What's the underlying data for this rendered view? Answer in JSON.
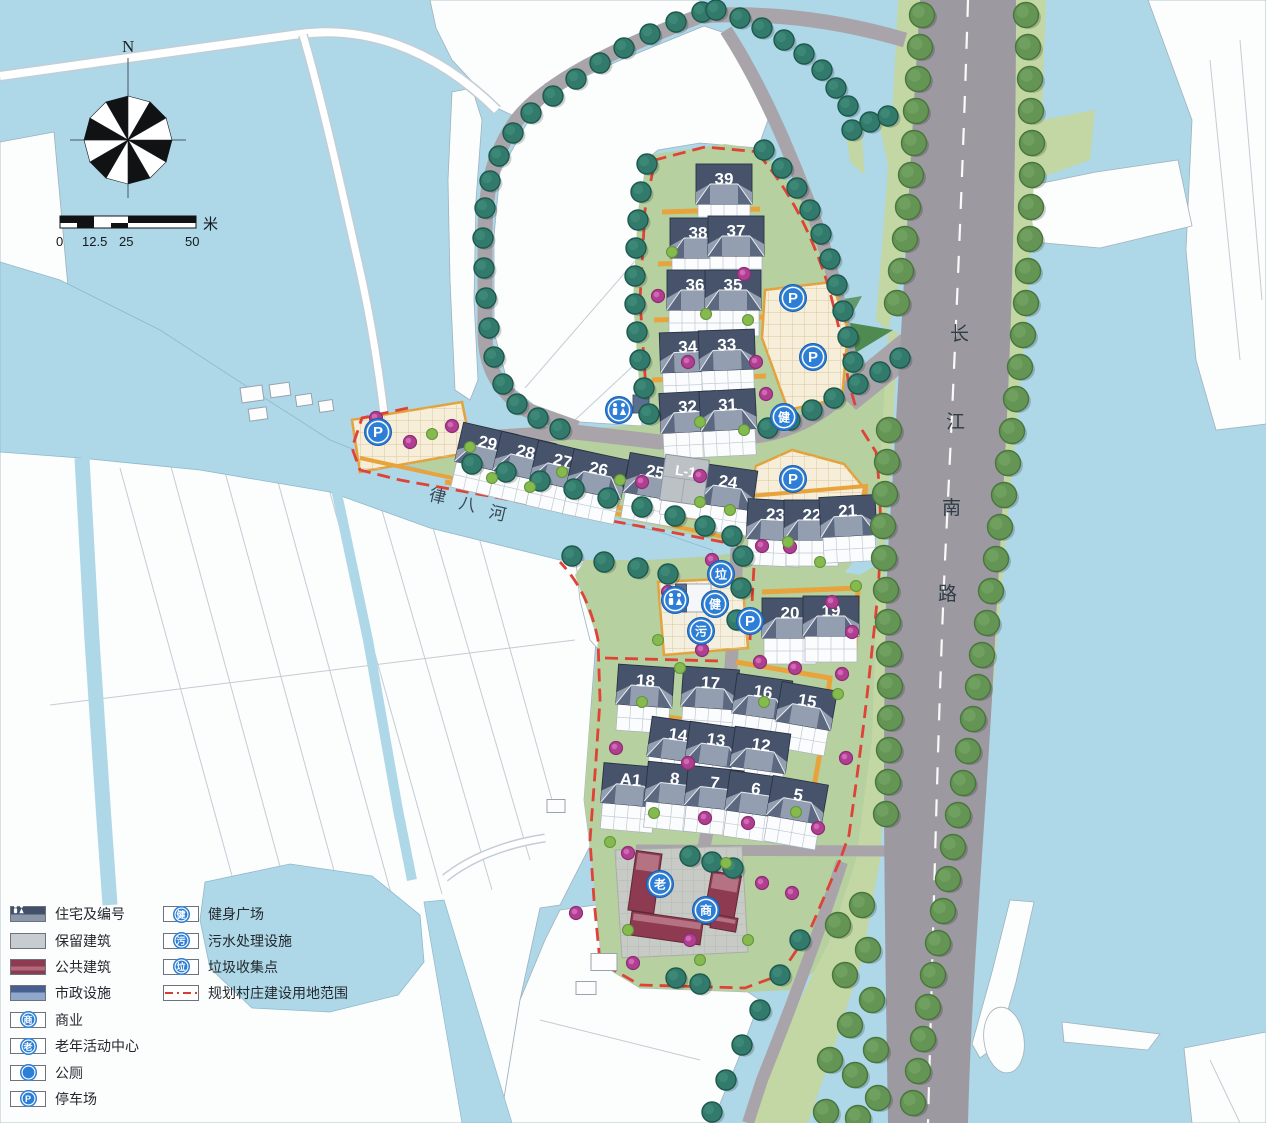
{
  "compass": {
    "north": "N"
  },
  "scale_bar": {
    "ticks": [
      "0",
      "12.5",
      "25",
      "50"
    ],
    "unit": "米"
  },
  "labels": {
    "river": [
      "律",
      "八",
      "河"
    ],
    "road": [
      "长",
      "江",
      "南",
      "路"
    ]
  },
  "legend": {
    "left": [
      {
        "label": "住宅及编号",
        "type": "swatch-residence"
      },
      {
        "label": "保留建筑",
        "type": "swatch-retained"
      },
      {
        "label": "公共建筑",
        "type": "swatch-public"
      },
      {
        "label": "市政设施",
        "type": "swatch-municipal"
      },
      {
        "label": "商业",
        "type": "icon",
        "glyph": "商"
      },
      {
        "label": "老年活动中心",
        "type": "icon",
        "glyph": "老"
      },
      {
        "label": "公厕",
        "type": "icon",
        "glyph": "WC"
      },
      {
        "label": "停车场",
        "type": "icon",
        "glyph": "P"
      }
    ],
    "right": [
      {
        "label": "健身广场",
        "type": "icon",
        "glyph": "健"
      },
      {
        "label": "污水处理设施",
        "type": "icon",
        "glyph": "污"
      },
      {
        "label": "垃圾收集点",
        "type": "icon",
        "glyph": "垃"
      },
      {
        "label": "规划村庄建设用地范围",
        "type": "boundary-line"
      }
    ]
  },
  "map": {
    "residential": [
      [
        "39",
        724,
        186,
        0
      ],
      [
        "38",
        698,
        240,
        0
      ],
      [
        "37",
        736,
        238,
        0
      ],
      [
        "36",
        695,
        292,
        0
      ],
      [
        "35",
        733,
        292,
        0
      ],
      [
        "34",
        688,
        354,
        -2
      ],
      [
        "33",
        727,
        352,
        -2
      ],
      [
        "32",
        688,
        414,
        -3
      ],
      [
        "31",
        728,
        412,
        -3
      ],
      [
        "29",
        486,
        450,
        13
      ],
      [
        "28",
        524,
        459,
        13
      ],
      [
        "27",
        561,
        468,
        13
      ],
      [
        "26",
        597,
        476,
        12
      ],
      [
        "25",
        654,
        479,
        10
      ],
      [
        "24",
        727,
        489,
        8
      ],
      [
        "23",
        775,
        522,
        3
      ],
      [
        "22",
        812,
        522,
        0
      ],
      [
        "21",
        848,
        518,
        -3
      ],
      [
        "20",
        790,
        620,
        0
      ],
      [
        "19",
        831,
        618,
        0
      ],
      [
        "18",
        645,
        688,
        4
      ],
      [
        "17",
        710,
        690,
        4
      ],
      [
        "16",
        762,
        699,
        8
      ],
      [
        "15",
        806,
        708,
        10
      ],
      [
        "14",
        677,
        742,
        8
      ],
      [
        "13",
        715,
        747,
        8
      ],
      [
        "12",
        760,
        752,
        8
      ],
      [
        "A1",
        630,
        787,
        5
      ],
      [
        "8",
        674,
        786,
        6
      ],
      [
        "7",
        714,
        790,
        6
      ],
      [
        "6",
        755,
        796,
        8
      ],
      [
        "5",
        797,
        802,
        10
      ]
    ],
    "retained": [
      [
        "L-1",
        684,
        483,
        8
      ]
    ],
    "public": [
      [
        645,
        882,
        26,
        60,
        8
      ],
      [
        666,
        928,
        72,
        24,
        8
      ],
      [
        722,
        900,
        30,
        54,
        10
      ],
      [
        724,
        923,
        26,
        14,
        10
      ]
    ],
    "municipal": [
      [
        641,
        404,
        16,
        18,
        0,
        "blue"
      ],
      [
        694,
        598,
        34,
        28,
        0,
        "white"
      ],
      [
        681,
        598,
        11,
        28,
        0,
        "blue"
      ]
    ],
    "existing": [
      [
        252,
        394,
        22,
        15,
        -8
      ],
      [
        280,
        390,
        20,
        13,
        -8
      ],
      [
        258,
        414,
        18,
        12,
        -8
      ],
      [
        304,
        400,
        16,
        11,
        -8
      ],
      [
        326,
        406,
        14,
        11,
        -8
      ],
      [
        556,
        806,
        18,
        13,
        0
      ],
      [
        604,
        962,
        26,
        17,
        0
      ],
      [
        586,
        988,
        20,
        13,
        0
      ]
    ],
    "trees_teal": [
      [
        702,
        12
      ],
      [
        676,
        22
      ],
      [
        650,
        34
      ],
      [
        624,
        48
      ],
      [
        600,
        63
      ],
      [
        576,
        79
      ],
      [
        553,
        96
      ],
      [
        531,
        113
      ],
      [
        513,
        133
      ],
      [
        499,
        156
      ],
      [
        490,
        181
      ],
      [
        485,
        208
      ],
      [
        483,
        238
      ],
      [
        484,
        268
      ],
      [
        486,
        298
      ],
      [
        489,
        328
      ],
      [
        494,
        357
      ],
      [
        503,
        384
      ],
      [
        517,
        404
      ],
      [
        538,
        418
      ],
      [
        560,
        429
      ],
      [
        647,
        164
      ],
      [
        641,
        192
      ],
      [
        638,
        220
      ],
      [
        636,
        248
      ],
      [
        635,
        276
      ],
      [
        635,
        304
      ],
      [
        637,
        332
      ],
      [
        640,
        360
      ],
      [
        644,
        388
      ],
      [
        649,
        414
      ],
      [
        764,
        150
      ],
      [
        782,
        168
      ],
      [
        797,
        188
      ],
      [
        810,
        210
      ],
      [
        821,
        234
      ],
      [
        830,
        259
      ],
      [
        837,
        285
      ],
      [
        843,
        311
      ],
      [
        848,
        337
      ],
      [
        853,
        362
      ],
      [
        768,
        428
      ],
      [
        790,
        420
      ],
      [
        812,
        410
      ],
      [
        834,
        398
      ],
      [
        858,
        384
      ],
      [
        880,
        372
      ],
      [
        900,
        358
      ],
      [
        472,
        464
      ],
      [
        506,
        472
      ],
      [
        540,
        481
      ],
      [
        574,
        489
      ],
      [
        608,
        498
      ],
      [
        642,
        507
      ],
      [
        675,
        516
      ],
      [
        705,
        526
      ],
      [
        732,
        536
      ],
      [
        572,
        556
      ],
      [
        604,
        562
      ],
      [
        638,
        568
      ],
      [
        668,
        574
      ],
      [
        716,
        10
      ],
      [
        740,
        18
      ],
      [
        762,
        28
      ],
      [
        784,
        40
      ],
      [
        804,
        54
      ],
      [
        822,
        70
      ],
      [
        836,
        88
      ],
      [
        848,
        106
      ],
      [
        690,
        856
      ],
      [
        712,
        862
      ],
      [
        733,
        868
      ],
      [
        676,
        978
      ],
      [
        700,
        984
      ],
      [
        800,
        940
      ],
      [
        780,
        975
      ],
      [
        760,
        1010
      ],
      [
        742,
        1045
      ],
      [
        726,
        1080
      ],
      [
        712,
        1112
      ],
      [
        743,
        556
      ],
      [
        741,
        588
      ],
      [
        737,
        620
      ],
      [
        852,
        130
      ],
      [
        870,
        122
      ],
      [
        888,
        116
      ]
    ],
    "trees_green": [
      [
        922,
        15
      ],
      [
        920,
        47
      ],
      [
        918,
        79
      ],
      [
        916,
        111
      ],
      [
        914,
        143
      ],
      [
        911,
        175
      ],
      [
        908,
        207
      ],
      [
        905,
        239
      ],
      [
        901,
        271
      ],
      [
        897,
        303
      ],
      [
        889,
        430
      ],
      [
        887,
        462
      ],
      [
        885,
        494
      ],
      [
        883,
        526
      ],
      [
        884,
        558
      ],
      [
        886,
        590
      ],
      [
        888,
        622
      ],
      [
        889,
        654
      ],
      [
        890,
        686
      ],
      [
        890,
        718
      ],
      [
        889,
        750
      ],
      [
        888,
        782
      ],
      [
        886,
        814
      ],
      [
        862,
        905
      ],
      [
        838,
        925
      ],
      [
        868,
        950
      ],
      [
        845,
        975
      ],
      [
        872,
        1000
      ],
      [
        850,
        1025
      ],
      [
        876,
        1050
      ],
      [
        855,
        1075
      ],
      [
        878,
        1098
      ],
      [
        858,
        1118
      ],
      [
        830,
        1060
      ],
      [
        826,
        1112
      ],
      [
        1026,
        15
      ],
      [
        1028,
        47
      ],
      [
        1030,
        79
      ],
      [
        1031,
        111
      ],
      [
        1032,
        143
      ],
      [
        1032,
        175
      ],
      [
        1031,
        207
      ],
      [
        1030,
        239
      ],
      [
        1028,
        271
      ],
      [
        1026,
        303
      ],
      [
        1023,
        335
      ],
      [
        1020,
        367
      ],
      [
        1016,
        399
      ],
      [
        1012,
        431
      ],
      [
        1008,
        463
      ],
      [
        1004,
        495
      ],
      [
        1000,
        527
      ],
      [
        996,
        559
      ],
      [
        991,
        591
      ],
      [
        987,
        623
      ],
      [
        982,
        655
      ],
      [
        978,
        687
      ],
      [
        973,
        719
      ],
      [
        968,
        751
      ],
      [
        963,
        783
      ],
      [
        958,
        815
      ],
      [
        953,
        847
      ],
      [
        948,
        879
      ],
      [
        943,
        911
      ],
      [
        938,
        943
      ],
      [
        933,
        975
      ],
      [
        928,
        1007
      ],
      [
        923,
        1039
      ],
      [
        918,
        1071
      ],
      [
        913,
        1103
      ]
    ],
    "shrubs_magenta": [
      [
        376,
        418
      ],
      [
        410,
        442
      ],
      [
        452,
        426
      ],
      [
        658,
        296
      ],
      [
        744,
        274
      ],
      [
        688,
        362
      ],
      [
        756,
        362
      ],
      [
        766,
        394
      ],
      [
        700,
        476
      ],
      [
        642,
        482
      ],
      [
        712,
        560
      ],
      [
        762,
        546
      ],
      [
        668,
        592
      ],
      [
        702,
        650
      ],
      [
        790,
        547
      ],
      [
        832,
        602
      ],
      [
        852,
        632
      ],
      [
        760,
        662
      ],
      [
        795,
        668
      ],
      [
        842,
        674
      ],
      [
        616,
        748
      ],
      [
        688,
        763
      ],
      [
        846,
        758
      ],
      [
        705,
        818
      ],
      [
        748,
        823
      ],
      [
        818,
        828
      ],
      [
        628,
        853
      ],
      [
        762,
        883
      ],
      [
        792,
        893
      ],
      [
        576,
        913
      ],
      [
        633,
        963
      ],
      [
        690,
        940
      ]
    ],
    "shrubs_green": [
      [
        432,
        434
      ],
      [
        470,
        447
      ],
      [
        562,
        472
      ],
      [
        620,
        480
      ],
      [
        700,
        502
      ],
      [
        730,
        510
      ],
      [
        672,
        252
      ],
      [
        706,
        314
      ],
      [
        748,
        320
      ],
      [
        700,
        422
      ],
      [
        744,
        430
      ],
      [
        788,
        542
      ],
      [
        820,
        562
      ],
      [
        856,
        586
      ],
      [
        642,
        702
      ],
      [
        764,
        702
      ],
      [
        838,
        694
      ],
      [
        654,
        813
      ],
      [
        796,
        812
      ],
      [
        610,
        842
      ],
      [
        726,
        863
      ],
      [
        748,
        940
      ],
      [
        700,
        960
      ],
      [
        628,
        930
      ],
      [
        492,
        478
      ],
      [
        530,
        487
      ],
      [
        658,
        640
      ],
      [
        680,
        668
      ]
    ],
    "icons": [
      {
        "name": "parking-icon",
        "glyph": "P",
        "x": 378,
        "y": 432
      },
      {
        "name": "parking-icon",
        "glyph": "P",
        "x": 793,
        "y": 298
      },
      {
        "name": "parking-icon",
        "glyph": "P",
        "x": 813,
        "y": 357
      },
      {
        "name": "parking-icon",
        "glyph": "P",
        "x": 793,
        "y": 479
      },
      {
        "name": "parking-icon",
        "glyph": "P",
        "x": 750,
        "y": 621
      },
      {
        "name": "fitness-icon",
        "glyph": "健",
        "x": 784,
        "y": 417
      },
      {
        "name": "fitness-icon",
        "glyph": "健",
        "x": 715,
        "y": 604
      },
      {
        "name": "sewage-icon",
        "glyph": "污",
        "x": 701,
        "y": 631
      },
      {
        "name": "garbage-icon",
        "glyph": "垃",
        "x": 721,
        "y": 574
      },
      {
        "name": "toilet-icon",
        "glyph": "WC",
        "x": 619,
        "y": 410
      },
      {
        "name": "toilet-icon",
        "glyph": "WC",
        "x": 675,
        "y": 600
      },
      {
        "name": "commerce-icon",
        "glyph": "商",
        "x": 706,
        "y": 910
      },
      {
        "name": "elderly-center-icon",
        "glyph": "老",
        "x": 660,
        "y": 884
      }
    ]
  },
  "colors": {
    "water": "#aed7e8",
    "farmland": "#fcfdfd",
    "site_green": "#b7d0a0",
    "verge_green": "#c3d7a4",
    "dark_green": "#4f8a50",
    "road": "#a8a4aa",
    "main_road": "#9d99a1",
    "lane_orange": "#e8a33d",
    "boundary_red": "#df4237",
    "plaza_beige": "#f6eed8",
    "paving_gray": "#c8cbc5",
    "roof_residential": "#46536b",
    "roof_light": "#939eb0",
    "building_public": "#8e3a50",
    "building_retained": "#bcc1c6",
    "municipal_blue": "#5a6e8e",
    "icon_blue": "#2d7ed5",
    "tree_teal": "#317a6c",
    "tree_green": "#649555",
    "shrub_magenta": "#b03f92",
    "shrub_green": "#85ba4f"
  }
}
